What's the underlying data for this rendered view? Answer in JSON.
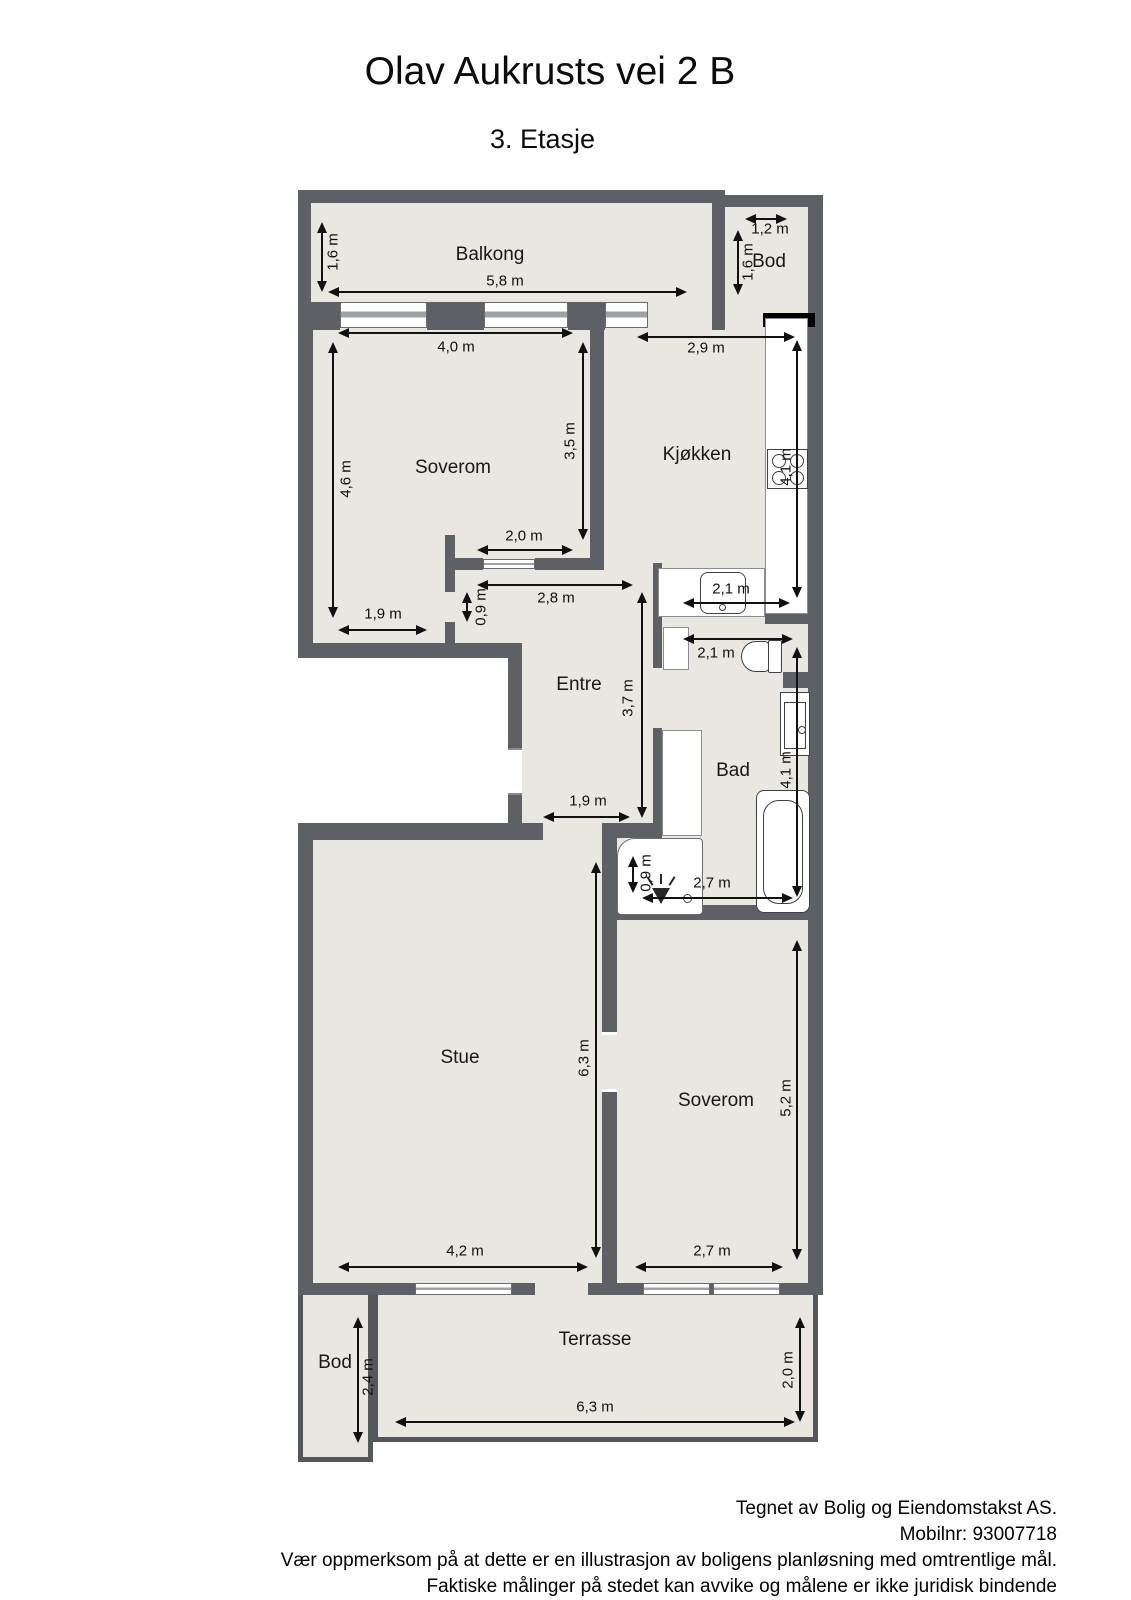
{
  "title": "Olav Aukrusts vei 2 B",
  "subtitle": "3. Etasje",
  "footer": {
    "line1": "Tegnet av Bolig og Eiendomstakst AS.",
    "line2": "Mobilnr: 93007718",
    "line3": "Vær oppmerksom på at dette er en illustrasjon av boligens planløsning med omtrentlige mål.",
    "line4": "Faktiske målinger på stedet kan avvike og målene er ikke juridisk bindende"
  },
  "colors": {
    "wall": "#5d6166",
    "floor": "#e9e7e0",
    "black_wall": "#000000",
    "dimension_line": "#111111"
  },
  "rooms": [
    {
      "id": "balkong",
      "label": "Balkong",
      "x": 490,
      "y": 255
    },
    {
      "id": "bod-top",
      "label": "Bod",
      "x": 769,
      "y": 262
    },
    {
      "id": "soverom-1",
      "label": "Soverom",
      "x": 453,
      "y": 468
    },
    {
      "id": "kjokken",
      "label": "Kjøkken",
      "x": 697,
      "y": 455
    },
    {
      "id": "entre",
      "label": "Entre",
      "x": 579,
      "y": 685
    },
    {
      "id": "bad",
      "label": "Bad",
      "x": 733,
      "y": 771
    },
    {
      "id": "stue",
      "label": "Stue",
      "x": 460,
      "y": 1058
    },
    {
      "id": "soverom-2",
      "label": "Soverom",
      "x": 716,
      "y": 1101
    },
    {
      "id": "bod-bottom",
      "label": "Bod",
      "x": 335,
      "y": 1363
    },
    {
      "id": "terrasse",
      "label": "Terrasse",
      "x": 595,
      "y": 1340
    }
  ],
  "dimensions": [
    {
      "id": "balkong-width",
      "label": "5,8 m",
      "o": "h",
      "x": 328,
      "y": 292,
      "len": 359,
      "lx": 505,
      "ly": 281,
      "rot": 0
    },
    {
      "id": "balkong-depth",
      "label": "1,6 m",
      "o": "v",
      "x": 322,
      "y": 222,
      "len": 70,
      "lx": 333,
      "ly": 252,
      "rot": 1
    },
    {
      "id": "bod-top-width",
      "label": "1,2 m",
      "o": "h",
      "x": 745,
      "y": 219,
      "len": 42,
      "lx": 770,
      "ly": 229,
      "rot": 0
    },
    {
      "id": "bod-top-depth",
      "label": "1,6 m",
      "o": "v",
      "x": 738,
      "y": 230,
      "len": 65,
      "lx": 748,
      "ly": 262,
      "rot": 1
    },
    {
      "id": "soverom1-width-top",
      "label": "4,0 m",
      "o": "h",
      "x": 338,
      "y": 333,
      "len": 235,
      "lx": 456,
      "ly": 347,
      "rot": 0
    },
    {
      "id": "soverom1-depth-left",
      "label": "4,6 m",
      "o": "v",
      "x": 333,
      "y": 342,
      "len": 276,
      "lx": 346,
      "ly": 479,
      "rot": 1
    },
    {
      "id": "soverom1-depth-right",
      "label": "3,5 m",
      "o": "v",
      "x": 583,
      "y": 342,
      "len": 198,
      "lx": 570,
      "ly": 441,
      "rot": 1
    },
    {
      "id": "soverom1-closet",
      "label": "2,0 m",
      "o": "h",
      "x": 477,
      "y": 550,
      "len": 96,
      "lx": 524,
      "ly": 536,
      "rot": 0
    },
    {
      "id": "soverom1-width-bot",
      "label": "1,9 m",
      "o": "h",
      "x": 338,
      "y": 630,
      "len": 89,
      "lx": 383,
      "ly": 614,
      "rot": 0
    },
    {
      "id": "kjokken-width",
      "label": "2,9 m",
      "o": "h",
      "x": 637,
      "y": 337,
      "len": 158,
      "lx": 706,
      "ly": 348,
      "rot": 0
    },
    {
      "id": "kjokken-depth",
      "label": "4,1 m",
      "o": "v",
      "x": 797,
      "y": 340,
      "len": 258,
      "lx": 786,
      "ly": 467,
      "rot": 1
    },
    {
      "id": "kjokken-benk",
      "label": "2,1 m",
      "o": "h",
      "x": 683,
      "y": 603,
      "len": 107,
      "lx": 731,
      "ly": 589,
      "rot": 0
    },
    {
      "id": "entre-dor",
      "label": "0,9 m",
      "o": "v",
      "x": 467,
      "y": 592,
      "len": 30,
      "lx": 481,
      "ly": 607,
      "rot": 1
    },
    {
      "id": "entre-width",
      "label": "2,8 m",
      "o": "h",
      "x": 477,
      "y": 585,
      "len": 156,
      "lx": 556,
      "ly": 598,
      "rot": 0
    },
    {
      "id": "entre-depth",
      "label": "3,7 m",
      "o": "v",
      "x": 642,
      "y": 592,
      "len": 226,
      "lx": 628,
      "ly": 698,
      "rot": 1
    },
    {
      "id": "entre-apning",
      "label": "1,9 m",
      "o": "h",
      "x": 543,
      "y": 817,
      "len": 87,
      "lx": 588,
      "ly": 801,
      "rot": 0
    },
    {
      "id": "bad-width-top",
      "label": "2,1 m",
      "o": "h",
      "x": 683,
      "y": 639,
      "len": 110,
      "lx": 716,
      "ly": 653,
      "rot": 0
    },
    {
      "id": "bad-depth",
      "label": "4,1 m",
      "o": "v",
      "x": 797,
      "y": 647,
      "len": 250,
      "lx": 786,
      "ly": 770,
      "rot": 1
    },
    {
      "id": "bad-dusj",
      "label": "0,9 m",
      "o": "v",
      "x": 633,
      "y": 856,
      "len": 37,
      "lx": 646,
      "ly": 873,
      "rot": 1
    },
    {
      "id": "bad-width-bottom",
      "label": "2,7 m",
      "o": "h",
      "x": 642,
      "y": 898,
      "len": 151,
      "lx": 712,
      "ly": 883,
      "rot": 0
    },
    {
      "id": "stue-depth",
      "label": "6,3 m",
      "o": "v",
      "x": 596,
      "y": 862,
      "len": 396,
      "lx": 584,
      "ly": 1058,
      "rot": 1
    },
    {
      "id": "stue-width",
      "label": "4,2 m",
      "o": "h",
      "x": 338,
      "y": 1267,
      "len": 250,
      "lx": 465,
      "ly": 1251,
      "rot": 0
    },
    {
      "id": "soverom2-depth",
      "label": "5,2 m",
      "o": "v",
      "x": 797,
      "y": 940,
      "len": 320,
      "lx": 786,
      "ly": 1098,
      "rot": 1
    },
    {
      "id": "soverom2-width",
      "label": "2,7 m",
      "o": "h",
      "x": 635,
      "y": 1267,
      "len": 148,
      "lx": 712,
      "ly": 1251,
      "rot": 0
    },
    {
      "id": "terrasse-width",
      "label": "6,3 m",
      "o": "h",
      "x": 395,
      "y": 1422,
      "len": 400,
      "lx": 595,
      "ly": 1407,
      "rot": 0
    },
    {
      "id": "terrasse-depth",
      "label": "2,0 m",
      "o": "v",
      "x": 800,
      "y": 1317,
      "len": 105,
      "lx": 788,
      "ly": 1370,
      "rot": 1
    },
    {
      "id": "bod-bottom-depth",
      "label": "2,4 m",
      "o": "v",
      "x": 358,
      "y": 1317,
      "len": 126,
      "lx": 368,
      "ly": 1377,
      "rot": 1
    }
  ],
  "fixtures": [
    "kitchen-counter",
    "stove",
    "kitchen-sink",
    "bathroom-cabinet-small",
    "toilet",
    "bathroom-vanity",
    "bathroom-cabinet-tall",
    "bathtub",
    "shower",
    "shower-head",
    "floor-drain"
  ]
}
